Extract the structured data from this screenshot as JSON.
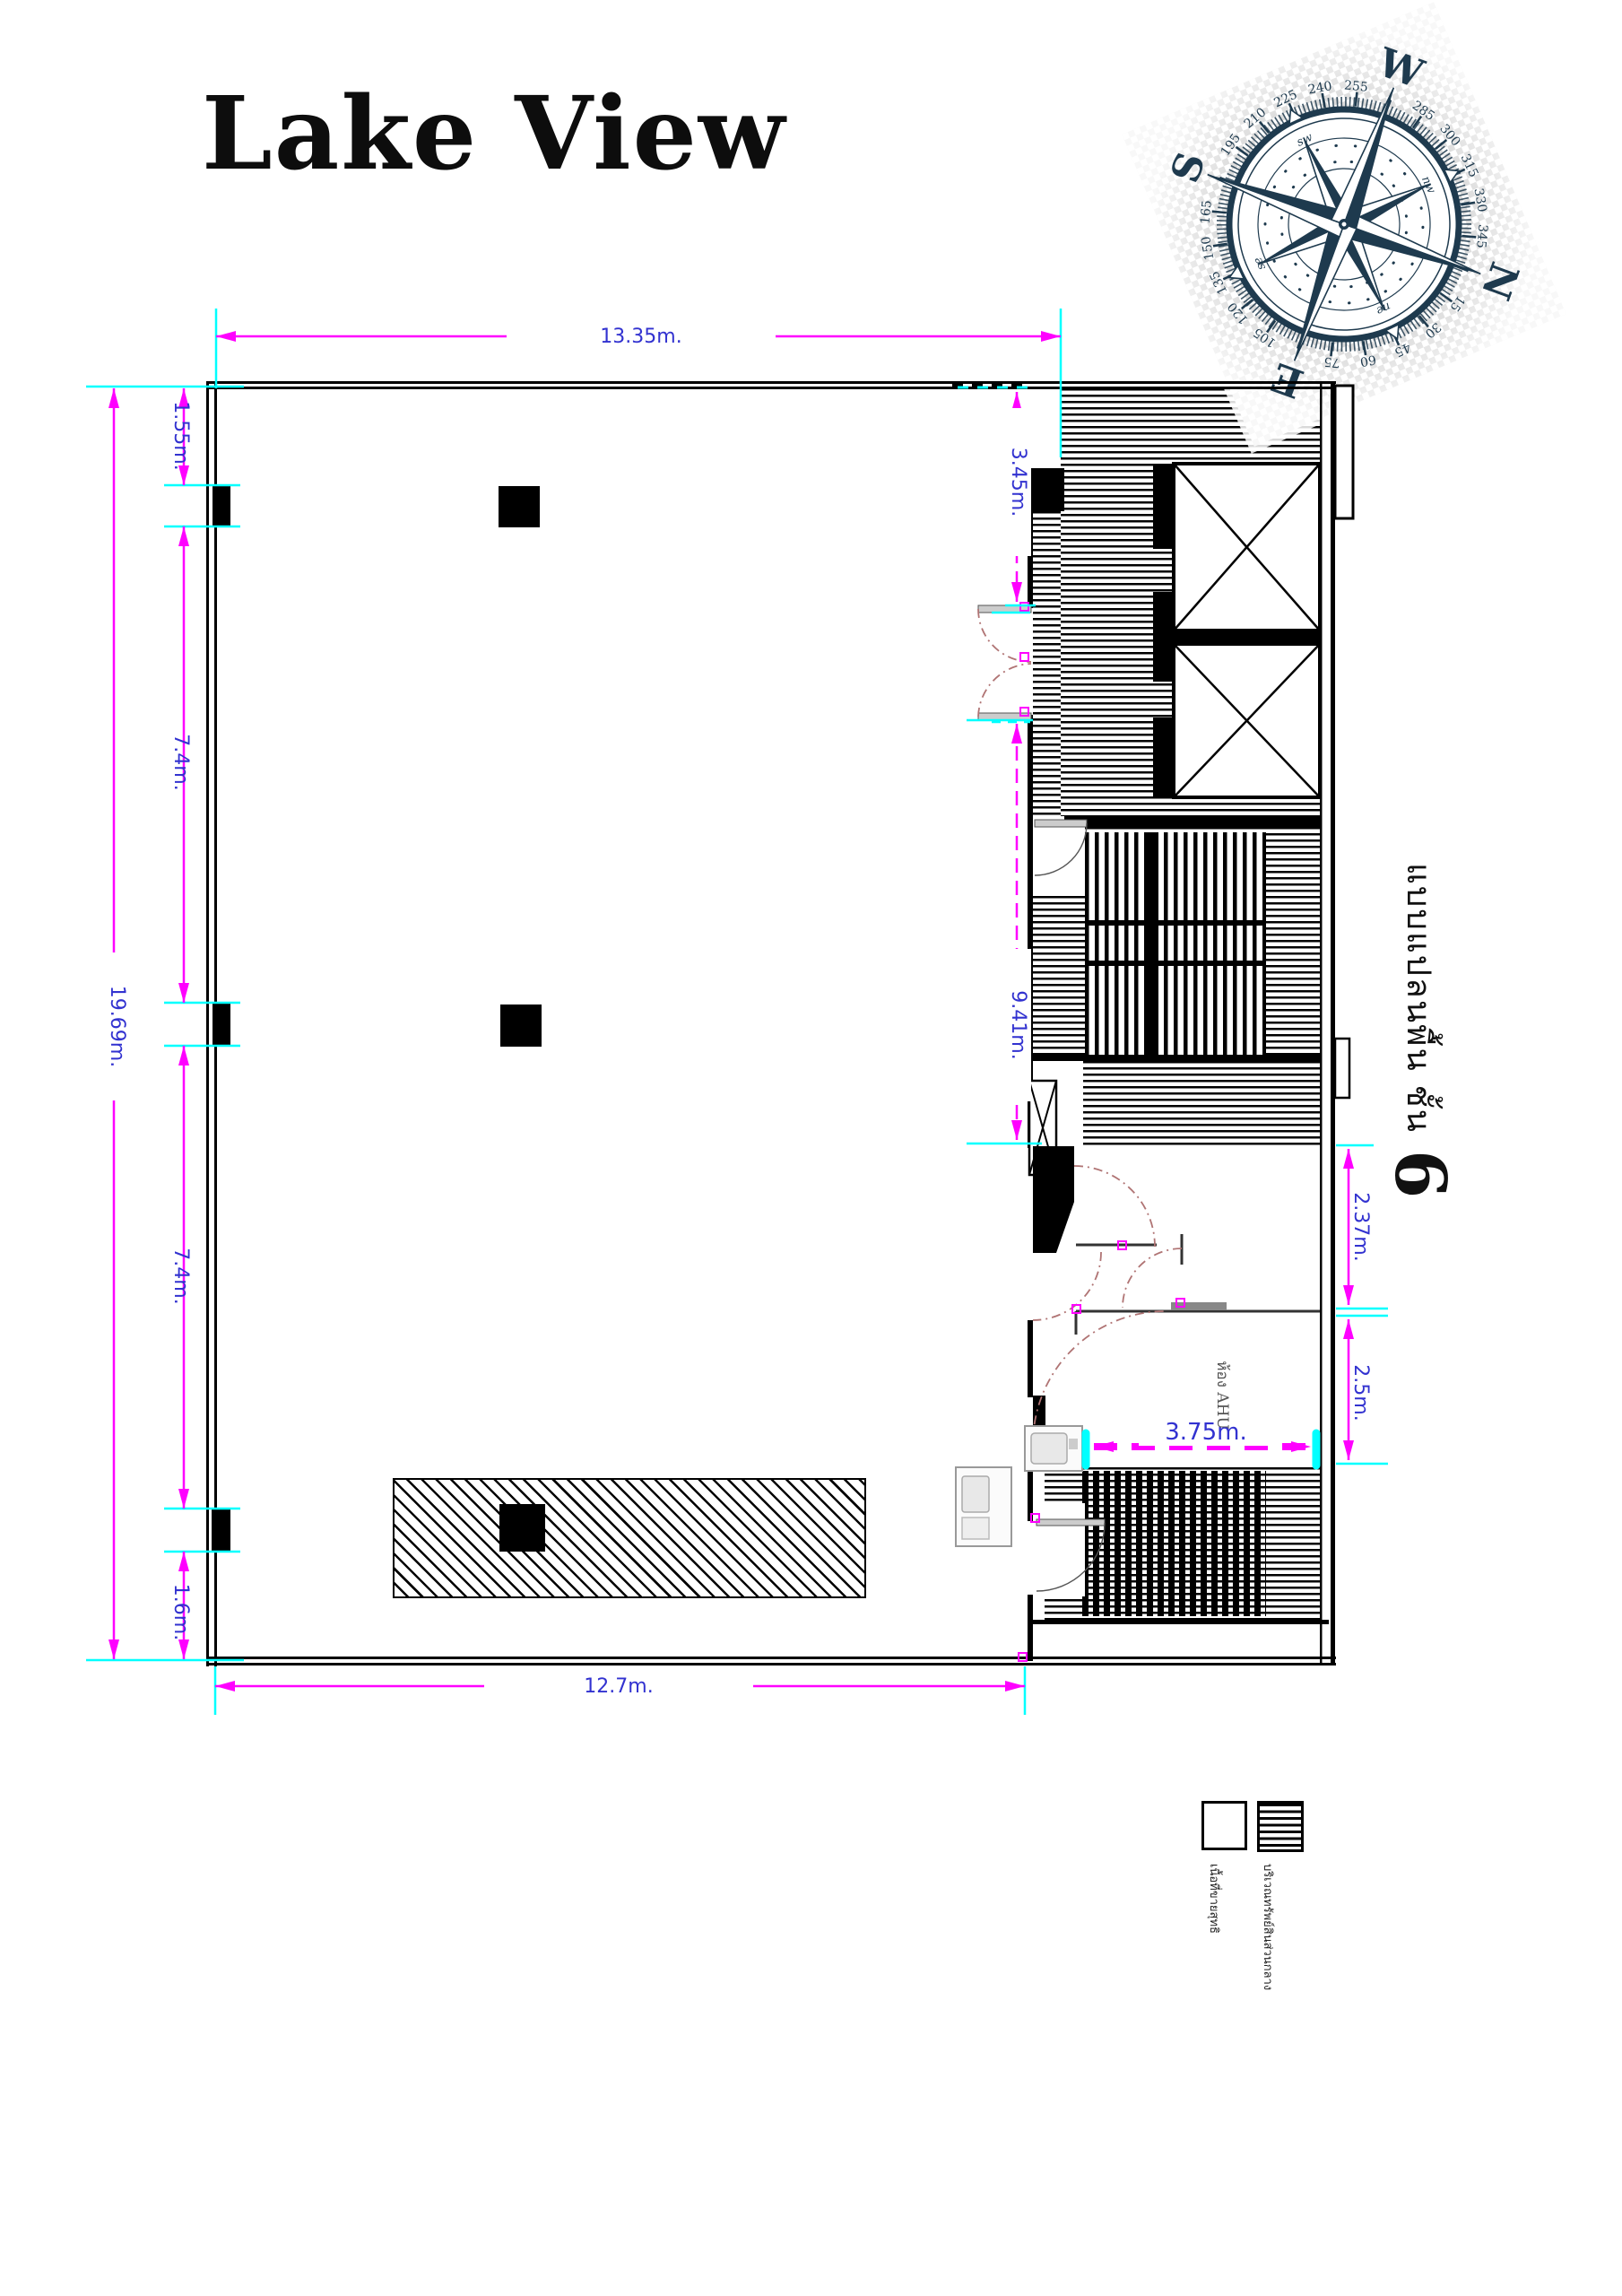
{
  "title": "Lake View",
  "compass": {
    "cardinals": {
      "north": "N",
      "east": "E",
      "south": "S",
      "west": "W"
    },
    "intercardinals": {
      "ne": "ne",
      "se": "se",
      "sw": "sw",
      "nw": "nw"
    },
    "degrees": [
      "15",
      "30",
      "45",
      "60",
      "75",
      "105",
      "120",
      "135",
      "150",
      "165",
      "195",
      "210",
      "225",
      "240",
      "255",
      "285",
      "300",
      "315",
      "330",
      "345"
    ],
    "color": "#1e3a4e"
  },
  "plan": {
    "room_labels": {
      "ahu": "ห้อง AHU"
    },
    "floor_label": {
      "text": "แบบแปลนพื้น ชั้น",
      "number": "6"
    },
    "dimensions": {
      "top_width": "13.35m.",
      "bottom_width": "12.7m.",
      "left_overall": "19.69m.",
      "left_chain": [
        "1.55m.",
        "7.4m.",
        "7.4m.",
        "1.6m."
      ],
      "right_upper": "3.45m.",
      "right_mid": "9.41m.",
      "right_lower_upper": "2.37m.",
      "right_lower_lower": "2.5m.",
      "ahu_width": "3.75m."
    },
    "colors": {
      "dimension_text": "#3232d0",
      "dimension_line": "#ff00ff",
      "extension_line": "#00ffff",
      "door_arc": "#b07474",
      "wall": "#000000"
    }
  },
  "legend": {
    "items": [
      {
        "swatch": "plain",
        "label": "เนื้อที่ขายสุทธิ"
      },
      {
        "swatch": "striped",
        "label": "บริเวณทรัพย์สินส่วนกลาง"
      }
    ]
  }
}
